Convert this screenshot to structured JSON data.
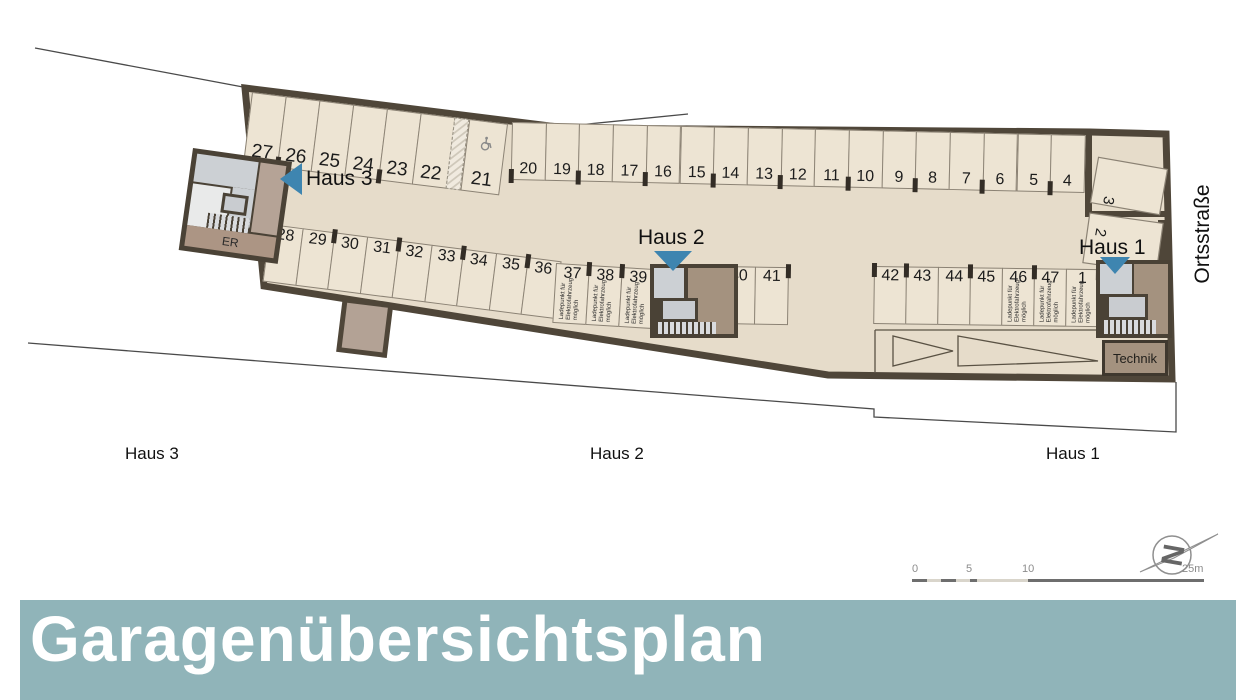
{
  "title": {
    "text": "Garagenübersichtsplan"
  },
  "plan": {
    "street_label": "Ortsstraße",
    "er_label": "ER",
    "technik_label": "Technik",
    "ev_note_lines": [
      "Ladepunkt für",
      "Elektrofahrzeug",
      "möglich"
    ],
    "accessible_space": "21",
    "rotated_spaces": {
      "upper": "3",
      "lower": "2"
    },
    "house_markers": [
      {
        "label": "Haus 3"
      },
      {
        "label": "Haus 2"
      },
      {
        "label": "Haus 1"
      }
    ],
    "house_footer_labels": [
      "Haus 3",
      "Haus 2",
      "Haus 1"
    ],
    "rows": {
      "top_left": [
        "27",
        "26",
        "25",
        "24",
        "23",
        "22"
      ],
      "top_right": [
        "20",
        "19",
        "18",
        "17",
        "16",
        "15",
        "14",
        "13",
        "12",
        "11",
        "10",
        "9",
        "8",
        "7",
        "6",
        "5",
        "4"
      ],
      "bottom_left": [
        "28",
        "29",
        "30",
        "31",
        "32",
        "33",
        "34",
        "35",
        "36"
      ],
      "bottom_mid_ev": [
        "37",
        "38",
        "39"
      ],
      "bottom_mid": [
        "40",
        "41"
      ],
      "bottom_right": [
        "42",
        "43",
        "44",
        "45",
        "46",
        "47",
        "1"
      ],
      "ev_equipped": [
        "37",
        "38",
        "39",
        "46",
        "47",
        "1"
      ]
    }
  },
  "scale_bar": {
    "ticks": [
      "0",
      "5",
      "10",
      "25m"
    ]
  },
  "north_arrow": {
    "letter": "N"
  },
  "colors": {
    "floor": "#e6dcca",
    "space_fill": "#ede4d3",
    "wall": "#4f4639",
    "room_gray": "#ccd0d4",
    "room_brown": "#a4927f",
    "arrow_blue": "#3e85b0",
    "title_bg": "#90b4b9",
    "title_text": "#ffffff"
  }
}
